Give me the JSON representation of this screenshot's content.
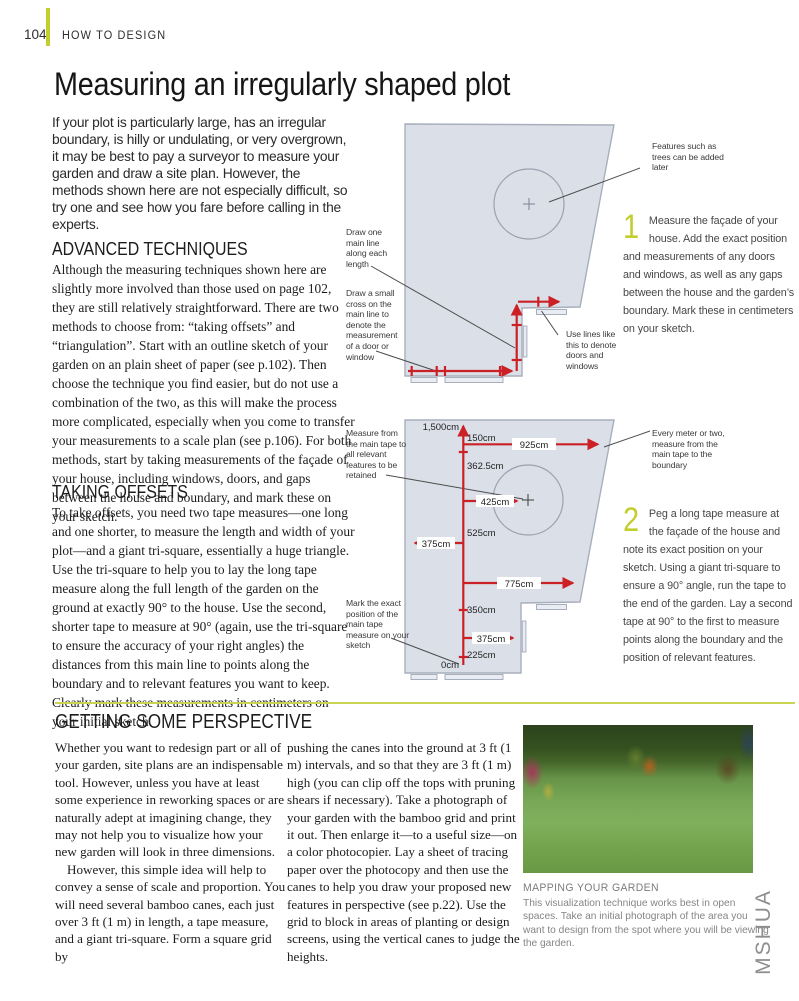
{
  "page": {
    "number": "104",
    "section": "HOW TO DESIGN",
    "title": "Measuring an irregularly shaped plot",
    "intro": "If your plot is particularly large, has an irregular boundary, is hilly or undulating, or very overgrown, it may be best to pay a surveyor to measure your garden and draw a site plan. However, the methods shown here are not especially difficult, so try one and see how you fare before calling in the experts.",
    "side_code": "MSHUA"
  },
  "advanced": {
    "heading": "ADVANCED TECHNIQUES",
    "body": "Although the measuring techniques shown here are slightly more involved than those used on page 102, they are still relatively straightforward. There are two methods to choose from: “taking offsets” and “triangulation”. Start with an outline sketch of your garden on an plain sheet of paper (see p.102). Then choose the technique you find easier, but do not use a combination of the two, as this will make the process more complicated, especially when you come to transfer your measurements to a scale plan (see p.106). For both methods, start by taking measurements of the façade of your house, including windows, doors, and gaps between the house and boundary, and mark these on your sketch."
  },
  "offsets": {
    "heading": "TAKING OFFSETS",
    "body": "To take offsets, you need two tape measures—one long and one shorter, to measure the length and width of your plot—and a giant tri-square, essentially a huge triangle. Use the tri-square to help you to lay the long tape measure along the full length of the garden on the ground at exactly 90° to the house. Use the second, shorter tape to measure at 90° (again, use the tri-square to ensure the accuracy of your right angles) the distances from this main line to points along the boundary and to relevant features you want to keep. Clearly mark these measurements in centimeters on your initial sketch."
  },
  "diagram1": {
    "labels": {
      "draw_line": "Draw one main line along each length",
      "draw_cross": "Draw a small cross on the main line to denote the measurement of a door or window",
      "use_lines": "Use lines like this to denote doors and windows",
      "features": "Features such as trees can be added later"
    },
    "step": {
      "number": "1",
      "text": "Measure the façade of your house. Add the exact position and measurements of any doors and windows, as well as any gaps between the house and the garden’s boundary. Mark these in centimeters on your sketch."
    }
  },
  "diagram2": {
    "labels": {
      "measure_from": "Measure from the main tape to all relevant features to be retained",
      "mark_exact": "Mark the exact position of the main tape measure on your sketch",
      "every_meter": "Every meter or two, measure from the main tape to the boundary"
    },
    "measurements": {
      "top": "1,500cm",
      "m150": "150cm",
      "m925": "925cm",
      "m362_5": "362.5cm",
      "m425": "425cm",
      "m525": "525cm",
      "m375l": "375cm",
      "m775": "775cm",
      "m350": "350cm",
      "m375r": "375cm",
      "m225": "225cm",
      "zero": "0cm"
    },
    "step": {
      "number": "2",
      "text": "Peg a long tape measure at the façade of the house and note its exact position on your sketch. Using a giant tri-square to ensure a 90° angle, run the tape to the end of the garden. Lay a second tape at 90° to the first to measure points along the boundary and the position of relevant features."
    }
  },
  "perspective": {
    "heading": "GETTING SOME PERSPECTIVE",
    "col1_p1": "Whether you want to redesign part or all of your garden, site plans are an indispensable tool. However, unless you have at least some experience in reworking spaces or are naturally adept at imagining change, they may not help you to visualize how your new garden will look in three dimensions.",
    "col1_p2": "However, this simple idea will help to convey a sense of scale and proportion. You will need several bamboo canes, each just over 3 ft (1 m) in length, a tape measure, and a giant tri-square. Form a square grid by",
    "col2": "pushing the canes into the ground at 3 ft (1 m) intervals, and so that they are 3 ft (1 m) high (you can clip off the tops with pruning shears if necessary). Take a photograph of your garden with the bamboo grid and print it out. Then enlarge it—to a useful size—on a color photocopier. Lay a sheet of tracing paper over the photocopy and then use the canes to help you draw your proposed new features in perspective (see p.22). Use the grid to block in areas of planting or design screens, using the vertical canes to judge the heights.",
    "caption_title": "MAPPING YOUR GARDEN",
    "caption_body": "This visualization technique works best in open spaces. Take an initial photograph of the area you want to design from the spot where you will be viewing the garden."
  },
  "colors": {
    "accent_green": "#c3ce2e",
    "rule_green": "#c9d453",
    "measure_red": "#cb2026",
    "plot_fill": "#dbdfe8",
    "plot_border": "#a8afbc"
  }
}
